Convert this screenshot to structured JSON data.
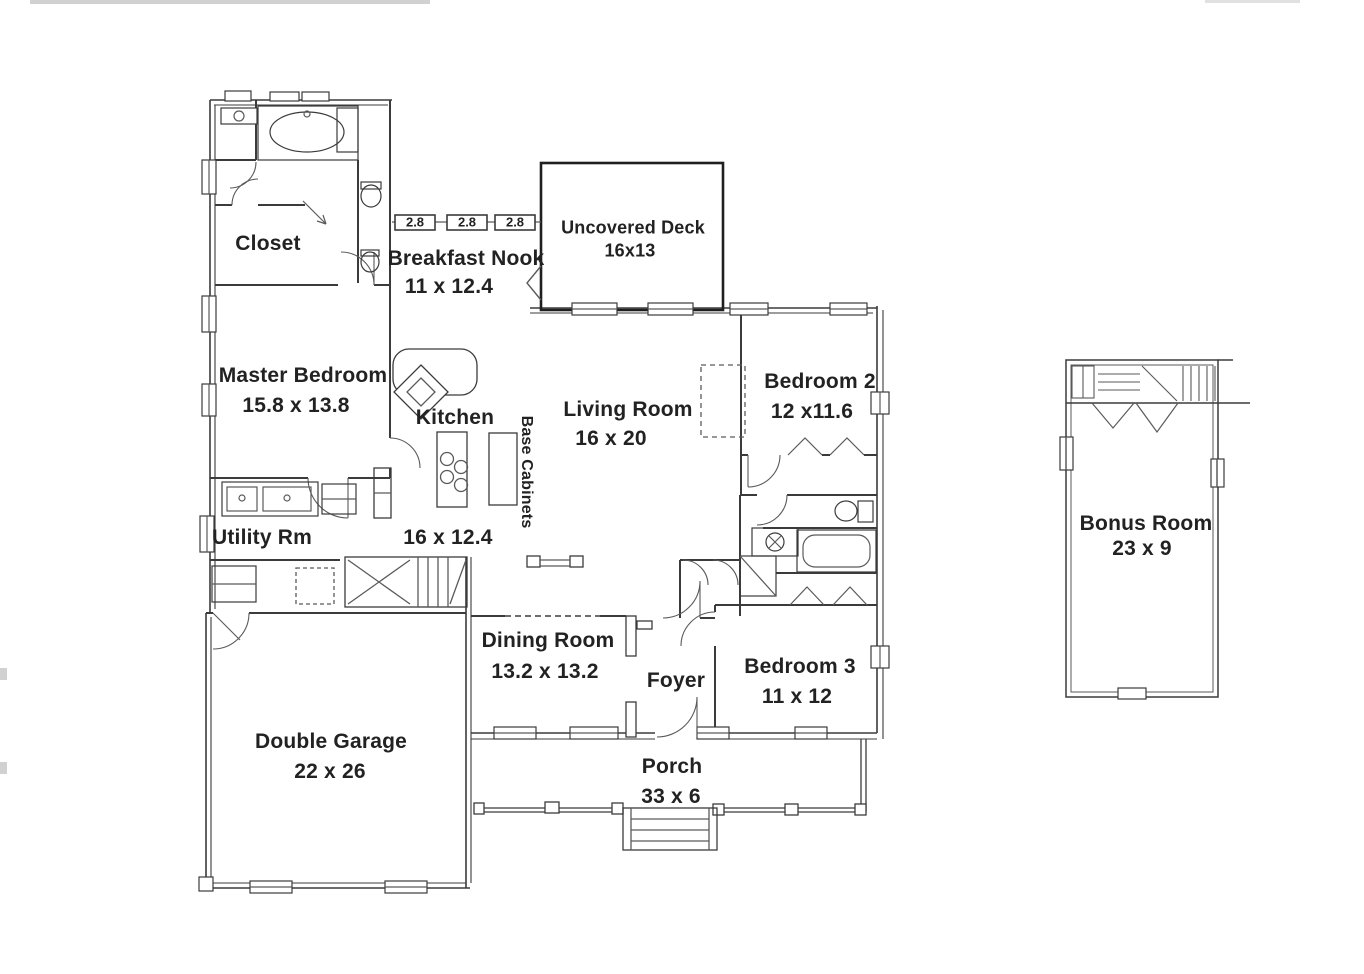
{
  "rooms": {
    "closet": {
      "label": "Closet"
    },
    "master_bedroom": {
      "label": "Master Bedroom",
      "dims": "15.8 x 13.8"
    },
    "breakfast_nook": {
      "label": "Breakfast Nook",
      "dims": "11 x 12.4"
    },
    "uncovered_deck": {
      "label": "Uncovered Deck",
      "dims": "16x13"
    },
    "living_room": {
      "label": "Living Room",
      "dims": "16 x 20"
    },
    "bedroom_2": {
      "label": "Bedroom 2",
      "dims": "12 x11.6"
    },
    "kitchen": {
      "label": "Kitchen",
      "dims": "16 x 12.4"
    },
    "base_cabinets": {
      "label": "Base Cabinets"
    },
    "utility_room": {
      "label": "Utility Rm"
    },
    "dining_room": {
      "label": "Dining Room",
      "dims": "13.2 x 13.2"
    },
    "foyer": {
      "label": "Foyer"
    },
    "bedroom_3": {
      "label": "Bedroom 3",
      "dims": "11 x 12"
    },
    "double_garage": {
      "label": "Double Garage",
      "dims": "22 x 26"
    },
    "porch": {
      "label": "Porch",
      "dims": "33 x 6"
    },
    "bonus_room": {
      "label": "Bonus Room",
      "dims": "23 x 9"
    }
  },
  "window_tags": [
    "2.8",
    "2.8",
    "2.8"
  ],
  "colors": {
    "background": "#ffffff",
    "wall": "#3b3b3b",
    "wall_light": "#5a5a5a",
    "deck": "#1f1f1f",
    "text": "#222222"
  }
}
